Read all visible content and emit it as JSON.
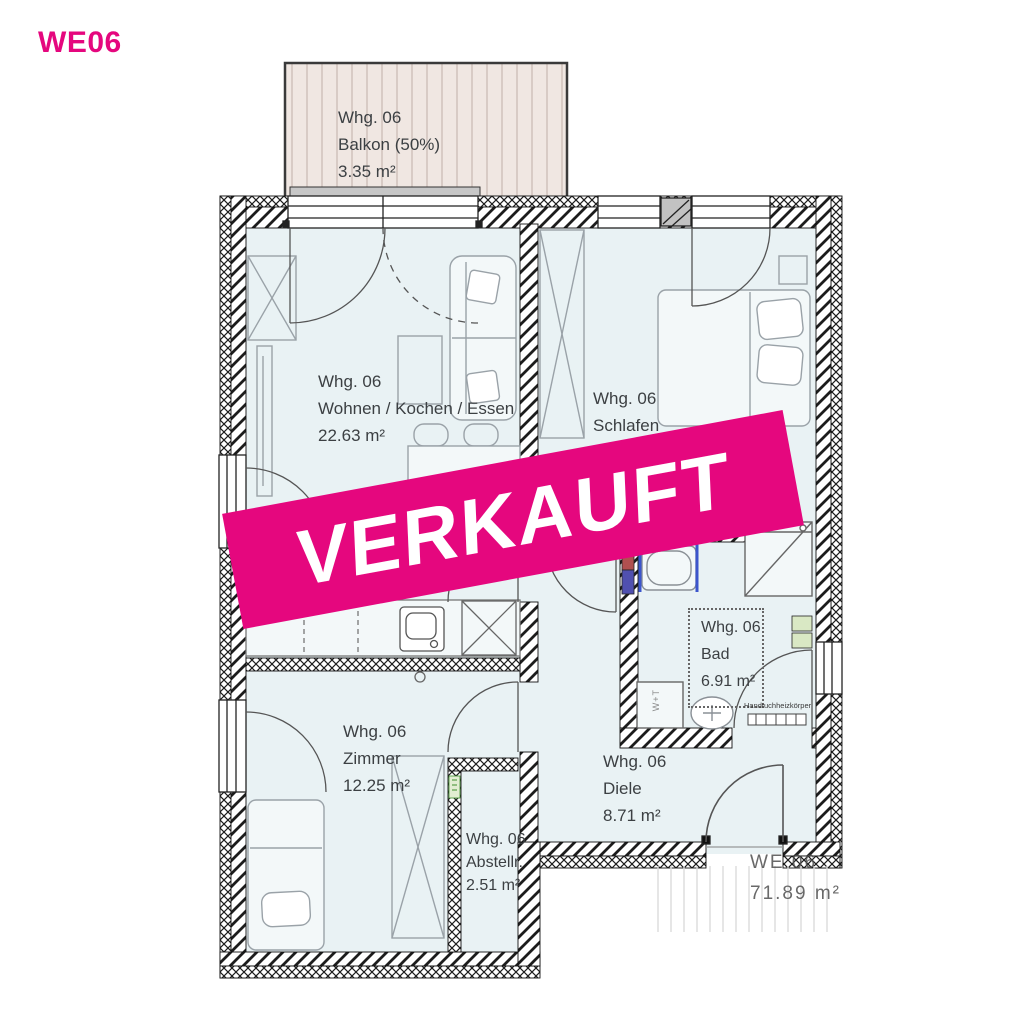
{
  "header": {
    "code": "WE06"
  },
  "banner": {
    "label": "VERKAUFT"
  },
  "rooms": [
    {
      "id": "balkon",
      "name_line": "Whg. 06",
      "type_line": "Balkon (50%)",
      "area_line": "3.35 m²"
    },
    {
      "id": "wohnen",
      "name_line": "Whg. 06",
      "type_line": "Wohnen / Kochen / Essen",
      "area_line": "22.63 m²"
    },
    {
      "id": "schlafen",
      "name_line": "Whg. 06",
      "type_line": "Schlafen",
      "area_line": ""
    },
    {
      "id": "bad",
      "name_line": "Whg. 06",
      "type_line": "Bad",
      "area_line": "6.91 m²"
    },
    {
      "id": "zimmer",
      "name_line": "Whg. 06",
      "type_line": "Zimmer",
      "area_line": "12.25 m²"
    },
    {
      "id": "diele",
      "name_line": "Whg. 06",
      "type_line": "Diele",
      "area_line": "8.71 m²"
    },
    {
      "id": "abstellraum",
      "name_line": "Whg. 06",
      "type_line": "Abstellr.",
      "area_line": "2.51 m²"
    }
  ],
  "unit_summary": {
    "code": "WE 06",
    "area": "71.89 m²"
  },
  "annotations": {
    "towel_radiator": "Handtuchheizkörper",
    "washer_dryer": "W+T"
  },
  "colors": {
    "accent_pink": "#E5077E",
    "floor": "#E9F2F4",
    "balcony_fill": "#F0E7E2",
    "glass_blue": "#3C55CC",
    "marker_green": "#D9E8C4",
    "wall_ink": "#1C1C1C",
    "label_text": "#3C4043"
  }
}
